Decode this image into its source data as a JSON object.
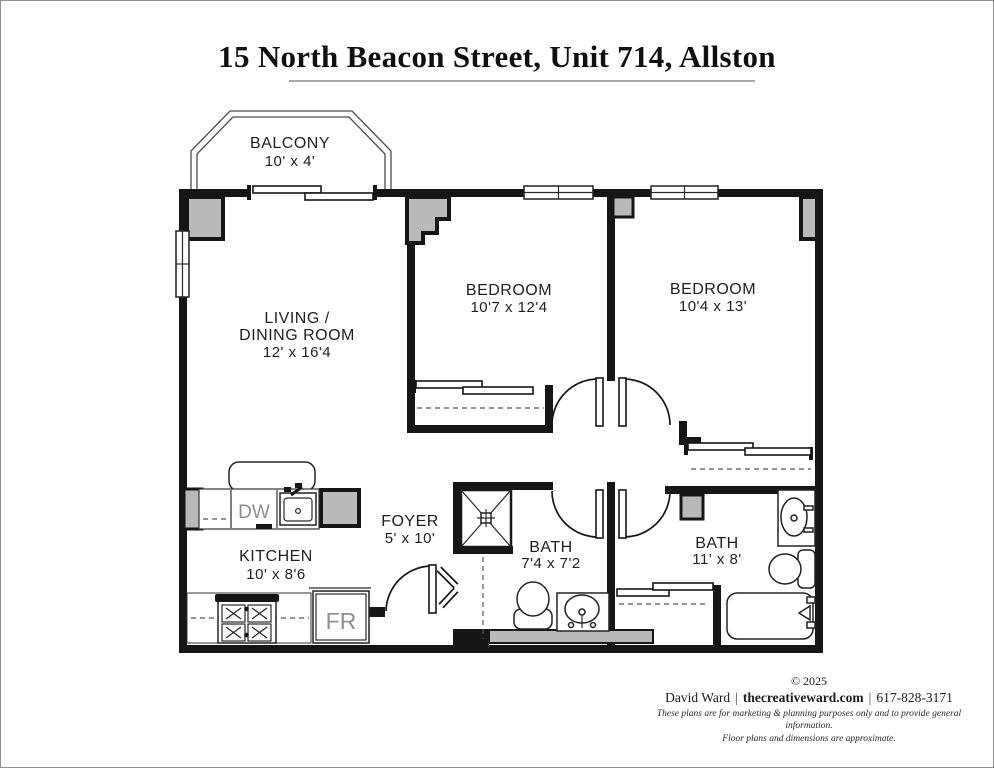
{
  "title": "15 North Beacon Street, Unit 714, Allston",
  "rooms": {
    "balcony": {
      "name": "BALCONY",
      "dims": "10' x 4'"
    },
    "living": {
      "line1": "LIVING /",
      "line2": "DINING ROOM",
      "dims": "12' x 16'4"
    },
    "bedroom1": {
      "name": "BEDROOM",
      "dims": "10'7 x 12'4"
    },
    "bedroom2": {
      "name": "BEDROOM",
      "dims": "10'4 x 13'"
    },
    "kitchen": {
      "name": "KITCHEN",
      "dims": "10' x 8'6"
    },
    "foyer": {
      "name": "FOYER",
      "dims": "5' x 10'"
    },
    "bath1": {
      "name": "BATH",
      "dims": "7'4 x 7'2"
    },
    "bath2": {
      "name": "BATH",
      "dims": "11' x 8'"
    }
  },
  "appliances": {
    "dishwasher": "DW",
    "refrigerator": "FR"
  },
  "footer": {
    "copyright": "© 2025",
    "author": "David Ward",
    "separator": "|",
    "website": "thecreativeward.com",
    "phone": "617-828-3171",
    "disclaimer1": "These plans are for marketing & planning purposes only and to provide general information.",
    "disclaimer2": "Floor plans and dimensions are approximate."
  },
  "colors": {
    "wall": "#161616",
    "pilaster_gray": "#b9b9b9",
    "floor": "#ffffff",
    "underline_gray": "#a9a9a9"
  }
}
